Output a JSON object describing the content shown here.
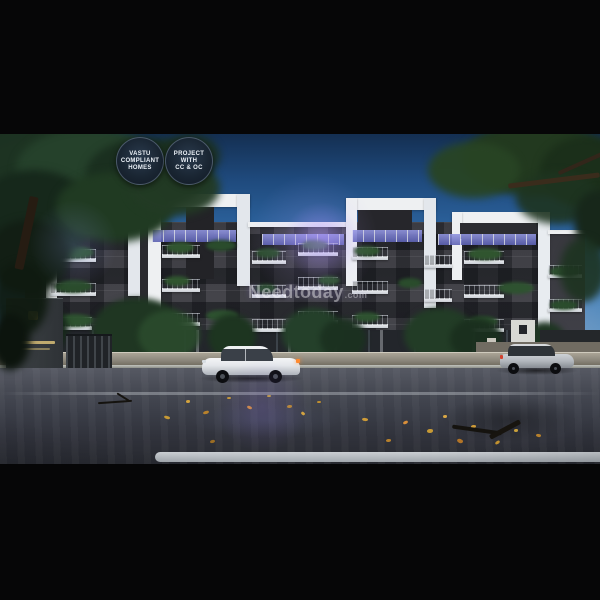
{
  "badges": [
    {
      "label": "VASTU\nCOMPLIANT\nHOMES"
    },
    {
      "label": "PROJECT\nWITH\nCC & OC"
    }
  ],
  "watermark": {
    "name": "Needtoday",
    "tld": ".com"
  },
  "palette": {
    "sky_top": "#1f4a7d",
    "sky_horizon": "#9db8d2",
    "facade_charcoal": "#3e3e44",
    "frame_white": "#eef0f2",
    "glass_purple": "#6b6fc8",
    "foliage_green": "#223a24",
    "road_asphalt": "#3a3d47",
    "road_marking": "#c3c8cd",
    "badge_bg": "#1a2633",
    "watermark_white": "rgba(255,255,255,0.42)",
    "taillight_orange": "#ff8a2f",
    "signboard_gold": "#d8be78"
  },
  "scene": {
    "white_bars": [
      {
        "x": 46,
        "y": 84,
        "w": 94,
        "h": 11
      },
      {
        "x": 46,
        "y": 84,
        "w": 11,
        "h": 124
      },
      {
        "x": 128,
        "y": 84,
        "w": 12,
        "h": 78,
        "c": "#e3e7ec"
      },
      {
        "x": 148,
        "y": 60,
        "w": 102,
        "h": 13
      },
      {
        "x": 148,
        "y": 60,
        "w": 13,
        "h": 122
      },
      {
        "x": 237,
        "y": 60,
        "w": 13,
        "h": 92,
        "c": "#e3e7ec"
      },
      {
        "x": 248,
        "y": 88,
        "w": 100,
        "h": 5
      },
      {
        "x": 346,
        "y": 64,
        "w": 90,
        "h": 12
      },
      {
        "x": 346,
        "y": 64,
        "w": 11,
        "h": 88
      },
      {
        "x": 424,
        "y": 64,
        "w": 12,
        "h": 110,
        "c": "#e3e7ec"
      },
      {
        "x": 452,
        "y": 78,
        "w": 98,
        "h": 11
      },
      {
        "x": 452,
        "y": 78,
        "w": 10,
        "h": 68
      },
      {
        "x": 538,
        "y": 78,
        "w": 12,
        "h": 124,
        "c": "#e8ecf0"
      },
      {
        "x": 25,
        "y": 106,
        "w": 23,
        "h": 4
      },
      {
        "x": 548,
        "y": 96,
        "w": 38,
        "h": 4
      }
    ],
    "dark_bars": [
      {
        "x": 186,
        "y": 73,
        "w": 28,
        "h": 72,
        "c": "#232327"
      },
      {
        "x": 358,
        "y": 76,
        "w": 54,
        "h": 20,
        "c": "#26262b"
      },
      {
        "x": 460,
        "y": 89,
        "w": 76,
        "h": 16,
        "c": "#2c2c31"
      },
      {
        "x": 140,
        "y": 88,
        "w": 8,
        "h": 100,
        "c": "#2a2a2f"
      }
    ],
    "glass_rows": [
      {
        "x": 152,
        "y": 96,
        "w": 84,
        "h": 12
      },
      {
        "x": 262,
        "y": 100,
        "w": 82,
        "h": 11
      },
      {
        "x": 352,
        "y": 96,
        "w": 70,
        "h": 12
      },
      {
        "x": 438,
        "y": 100,
        "w": 98,
        "h": 11
      }
    ],
    "balconies": [
      {
        "x": 50,
        "y": 124,
        "w": 46
      },
      {
        "x": 50,
        "y": 158,
        "w": 46
      },
      {
        "x": 50,
        "y": 192,
        "w": 42
      },
      {
        "x": 162,
        "y": 120,
        "w": 38
      },
      {
        "x": 162,
        "y": 154,
        "w": 38
      },
      {
        "x": 162,
        "y": 188,
        "w": 38
      },
      {
        "x": 252,
        "y": 126,
        "w": 34
      },
      {
        "x": 252,
        "y": 160,
        "w": 34
      },
      {
        "x": 252,
        "y": 194,
        "w": 34
      },
      {
        "x": 298,
        "y": 118,
        "w": 40
      },
      {
        "x": 298,
        "y": 152,
        "w": 40
      },
      {
        "x": 298,
        "y": 186,
        "w": 40
      },
      {
        "x": 352,
        "y": 122,
        "w": 36
      },
      {
        "x": 352,
        "y": 156,
        "w": 36
      },
      {
        "x": 352,
        "y": 190,
        "w": 36
      },
      {
        "x": 424,
        "y": 130,
        "w": 28
      },
      {
        "x": 424,
        "y": 164,
        "w": 28
      },
      {
        "x": 464,
        "y": 126,
        "w": 40
      },
      {
        "x": 464,
        "y": 160,
        "w": 40
      },
      {
        "x": 464,
        "y": 194,
        "w": 40
      },
      {
        "x": 548,
        "y": 140,
        "w": 34
      },
      {
        "x": 548,
        "y": 174,
        "w": 34
      }
    ],
    "plants": [
      {
        "x": 52,
        "y": 112,
        "w": 42,
        "h": 13,
        "c": "#2e5230"
      },
      {
        "x": 54,
        "y": 146,
        "w": 38,
        "h": 13,
        "c": "#2a4c2c"
      },
      {
        "x": 56,
        "y": 180,
        "w": 38,
        "h": 13,
        "c": "#2e5230"
      },
      {
        "x": 166,
        "y": 108,
        "w": 28,
        "h": 11,
        "c": "#30552f"
      },
      {
        "x": 206,
        "y": 106,
        "w": 30,
        "h": 11,
        "c": "#2a4c2c"
      },
      {
        "x": 164,
        "y": 142,
        "w": 26,
        "h": 10,
        "c": "#30552f"
      },
      {
        "x": 206,
        "y": 176,
        "w": 32,
        "h": 11,
        "c": "#2e5230"
      },
      {
        "x": 256,
        "y": 114,
        "w": 24,
        "h": 10,
        "c": "#2a4c2c"
      },
      {
        "x": 302,
        "y": 106,
        "w": 26,
        "h": 10,
        "c": "#30552f"
      },
      {
        "x": 318,
        "y": 142,
        "w": 22,
        "h": 9,
        "c": "#2e5230"
      },
      {
        "x": 256,
        "y": 150,
        "w": 20,
        "h": 9,
        "c": "#2a4c2c"
      },
      {
        "x": 354,
        "y": 112,
        "w": 26,
        "h": 10,
        "c": "#30552f"
      },
      {
        "x": 398,
        "y": 144,
        "w": 24,
        "h": 10,
        "c": "#2a4c2c"
      },
      {
        "x": 354,
        "y": 178,
        "w": 26,
        "h": 10,
        "c": "#2e5230"
      },
      {
        "x": 468,
        "y": 114,
        "w": 34,
        "h": 12,
        "c": "#30552f"
      },
      {
        "x": 498,
        "y": 148,
        "w": 36,
        "h": 12,
        "c": "#2e5230"
      },
      {
        "x": 468,
        "y": 182,
        "w": 30,
        "h": 11,
        "c": "#2a4c2c"
      },
      {
        "x": 550,
        "y": 132,
        "w": 30,
        "h": 11,
        "c": "#2e5230"
      },
      {
        "x": 550,
        "y": 166,
        "w": 28,
        "h": 10,
        "c": "#2a4c2c"
      }
    ],
    "bushes": [
      {
        "x": 10,
        "y": 168,
        "w": 58,
        "h": 54,
        "c": "#16281a"
      },
      {
        "x": 92,
        "y": 164,
        "w": 92,
        "h": 62,
        "c": "#1f3622"
      },
      {
        "x": 138,
        "y": 176,
        "w": 62,
        "h": 50,
        "c": "#2a4a2c",
        "o": 0.95
      },
      {
        "x": 208,
        "y": 180,
        "w": 48,
        "h": 46,
        "c": "#1d3520"
      },
      {
        "x": 282,
        "y": 174,
        "w": 62,
        "h": 52,
        "c": "#24402a"
      },
      {
        "x": 320,
        "y": 184,
        "w": 46,
        "h": 42,
        "c": "#1b3120",
        "o": 0.95
      },
      {
        "x": 404,
        "y": 174,
        "w": 72,
        "h": 54,
        "c": "#223c26"
      },
      {
        "x": 450,
        "y": 184,
        "w": 52,
        "h": 42,
        "c": "#1a2f1e",
        "o": 0.95
      },
      {
        "x": 524,
        "y": 188,
        "w": 42,
        "h": 38,
        "c": "#1e3522"
      }
    ],
    "canopy": [
      {
        "x": -40,
        "y": -16,
        "w": 150,
        "h": 92,
        "c": "#1d3322"
      },
      {
        "x": 16,
        "y": -6,
        "w": 150,
        "h": 82,
        "c": "#25412b"
      },
      {
        "x": 86,
        "y": 4,
        "w": 124,
        "h": 72,
        "c": "#1a2f1f"
      },
      {
        "x": -26,
        "y": 36,
        "w": 120,
        "h": 92,
        "c": "#16281b"
      },
      {
        "x": 56,
        "y": 38,
        "w": 118,
        "h": 70,
        "c": "#203a22"
      },
      {
        "x": 128,
        "y": 26,
        "w": 92,
        "h": 56,
        "c": "#223a24",
        "o": 0.95
      },
      {
        "x": -14,
        "y": 86,
        "w": 84,
        "h": 74,
        "c": "#121e14"
      },
      {
        "x": -8,
        "y": 128,
        "w": 56,
        "h": 74,
        "c": "#0f1a10",
        "o": 0.95
      },
      {
        "x": -10,
        "y": 180,
        "w": 40,
        "h": 56,
        "c": "#0c140d"
      },
      {
        "x": 160,
        "y": 0,
        "w": 60,
        "h": 44,
        "c": "#1c3120",
        "o": 0.9
      },
      {
        "x": 462,
        "y": -12,
        "w": 146,
        "h": 74,
        "c": "#22391f"
      },
      {
        "x": 540,
        "y": 2,
        "w": 96,
        "h": 72,
        "c": "#1b2f1a"
      },
      {
        "x": 428,
        "y": 8,
        "w": 92,
        "h": 56,
        "c": "#284424",
        "o": 0.95
      },
      {
        "x": 516,
        "y": 38,
        "w": 84,
        "h": 52,
        "c": "#1e3420",
        "o": 0.9
      },
      {
        "x": 574,
        "y": 56,
        "w": 50,
        "h": 62,
        "c": "#17271a"
      },
      {
        "x": 560,
        "y": 104,
        "w": 46,
        "h": 64,
        "c": "#1d3320",
        "o": 0.9
      }
    ],
    "branches": [
      {
        "x": 22,
        "y": 62,
        "w": 9,
        "h": 74,
        "rot": 12,
        "c": "#261c12"
      },
      {
        "x": 508,
        "y": 44,
        "w": 92,
        "h": 5,
        "rot": -7,
        "c": "#3a2c1c"
      },
      {
        "x": 556,
        "y": 26,
        "w": 56,
        "h": 4,
        "rot": -24,
        "c": "#32261a"
      }
    ],
    "leaves": [
      {
        "x": 164,
        "y": 282,
        "w": 6,
        "h": 3,
        "c": "#c79a35",
        "rot": 20
      },
      {
        "x": 186,
        "y": 266,
        "w": 4,
        "h": 3,
        "c": "#d4a43e"
      },
      {
        "x": 203,
        "y": 277,
        "w": 6,
        "h": 3,
        "c": "#b8812c",
        "rot": -15
      },
      {
        "x": 227,
        "y": 263,
        "w": 4,
        "h": 2,
        "c": "#c79a35"
      },
      {
        "x": 247,
        "y": 272,
        "w": 5,
        "h": 3,
        "c": "#d98f3a",
        "rot": 30
      },
      {
        "x": 267,
        "y": 261,
        "w": 4,
        "h": 2,
        "c": "#caa23c"
      },
      {
        "x": 287,
        "y": 271,
        "w": 5,
        "h": 3,
        "c": "#bd8a30"
      },
      {
        "x": 301,
        "y": 278,
        "w": 4,
        "h": 3,
        "c": "#d4a43e",
        "rot": 45
      },
      {
        "x": 317,
        "y": 267,
        "w": 4,
        "h": 2,
        "c": "#c2912f"
      },
      {
        "x": 362,
        "y": 284,
        "w": 6,
        "h": 3,
        "c": "#cf9c38",
        "rot": 10
      },
      {
        "x": 386,
        "y": 305,
        "w": 5,
        "h": 3,
        "c": "#b8812c"
      },
      {
        "x": 403,
        "y": 287,
        "w": 5,
        "h": 3,
        "c": "#d98f3a",
        "rot": -20
      },
      {
        "x": 427,
        "y": 295,
        "w": 6,
        "h": 4,
        "c": "#c79a35"
      },
      {
        "x": 443,
        "y": 281,
        "w": 4,
        "h": 3,
        "c": "#dba845"
      },
      {
        "x": 457,
        "y": 305,
        "w": 6,
        "h": 4,
        "c": "#b27427",
        "rot": 25
      },
      {
        "x": 471,
        "y": 291,
        "w": 5,
        "h": 3,
        "c": "#cf9c38"
      },
      {
        "x": 495,
        "y": 307,
        "w": 5,
        "h": 3,
        "c": "#c2912f",
        "rot": -30
      },
      {
        "x": 514,
        "y": 295,
        "w": 4,
        "h": 3,
        "c": "#caa23c"
      },
      {
        "x": 536,
        "y": 300,
        "w": 5,
        "h": 3,
        "c": "#b8812c",
        "rot": 15
      },
      {
        "x": 210,
        "y": 306,
        "w": 5,
        "h": 3,
        "c": "#9b6d24",
        "rot": -10
      }
    ],
    "debris": [
      {
        "x": 452,
        "y": 294,
        "w": 50,
        "h": 4,
        "rot": 8,
        "c": "#15130f"
      },
      {
        "x": 488,
        "y": 293,
        "w": 34,
        "h": 5,
        "rot": -28,
        "c": "#17140f"
      },
      {
        "x": 98,
        "y": 267,
        "w": 34,
        "h": 2,
        "rot": -4,
        "c": "#15130f"
      },
      {
        "x": 116,
        "y": 262,
        "w": 14,
        "h": 2,
        "rot": 32,
        "c": "#15130f"
      }
    ],
    "flares": [
      {
        "x": 284,
        "y": 68,
        "r": 38,
        "c": "rgba(170,140,255,0.45)",
        "n": "lens-flare-purple"
      },
      {
        "x": 250,
        "y": 40,
        "r": 64,
        "c": "rgba(185,165,255,0.22)",
        "n": "lens-flare-halo"
      },
      {
        "x": 30,
        "y": 66,
        "r": 44,
        "c": "rgba(150,165,255,0.2)",
        "n": "lens-flare-blue"
      },
      {
        "x": 216,
        "y": 226,
        "r": 46,
        "c": "rgba(130,100,210,0.2)",
        "n": "road-reflection-purple"
      }
    ]
  }
}
